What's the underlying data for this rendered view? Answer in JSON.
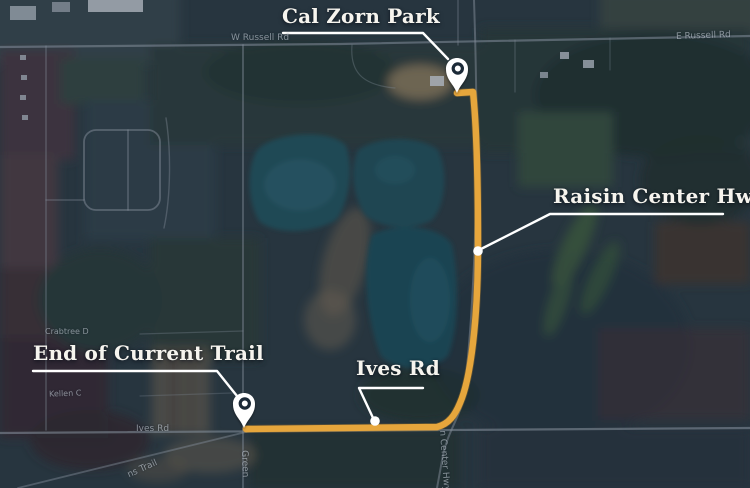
{
  "map": {
    "kind": "satellite-route-overview",
    "callouts": {
      "cal_zorn_park": {
        "label": "Cal Zorn Park"
      },
      "raisin_center_hwy": {
        "label": "Raisin Center Hwy"
      },
      "end_of_current_trail": {
        "label": "End of Current Trail"
      },
      "ives_rd": {
        "label": "Ives Rd"
      }
    },
    "base_map_labels": {
      "w_russell_rd": "W Russell Rd",
      "e_russell_rd": "E Russell Rd",
      "ives_rd": "Ives Rd",
      "trail_fragment": "ns Trail",
      "green_road_fragment": "Green",
      "raisin_center_hwy_fragment": "n Center Hwy",
      "crabtree_fragment": "Crabtree D",
      "kellen_fragment": "Kellen C"
    },
    "icons": {
      "map_pin": "teardrop-location-marker",
      "route_dot": "filled-circle-waypoint"
    },
    "colors": {
      "route": "#E6A63C",
      "connector_line": "#FFFFFF",
      "callout_text": "#F6F4EE",
      "pin_fill": "#FFFFFF",
      "pin_ring": "#1E2A38",
      "water": "#225058"
    }
  }
}
